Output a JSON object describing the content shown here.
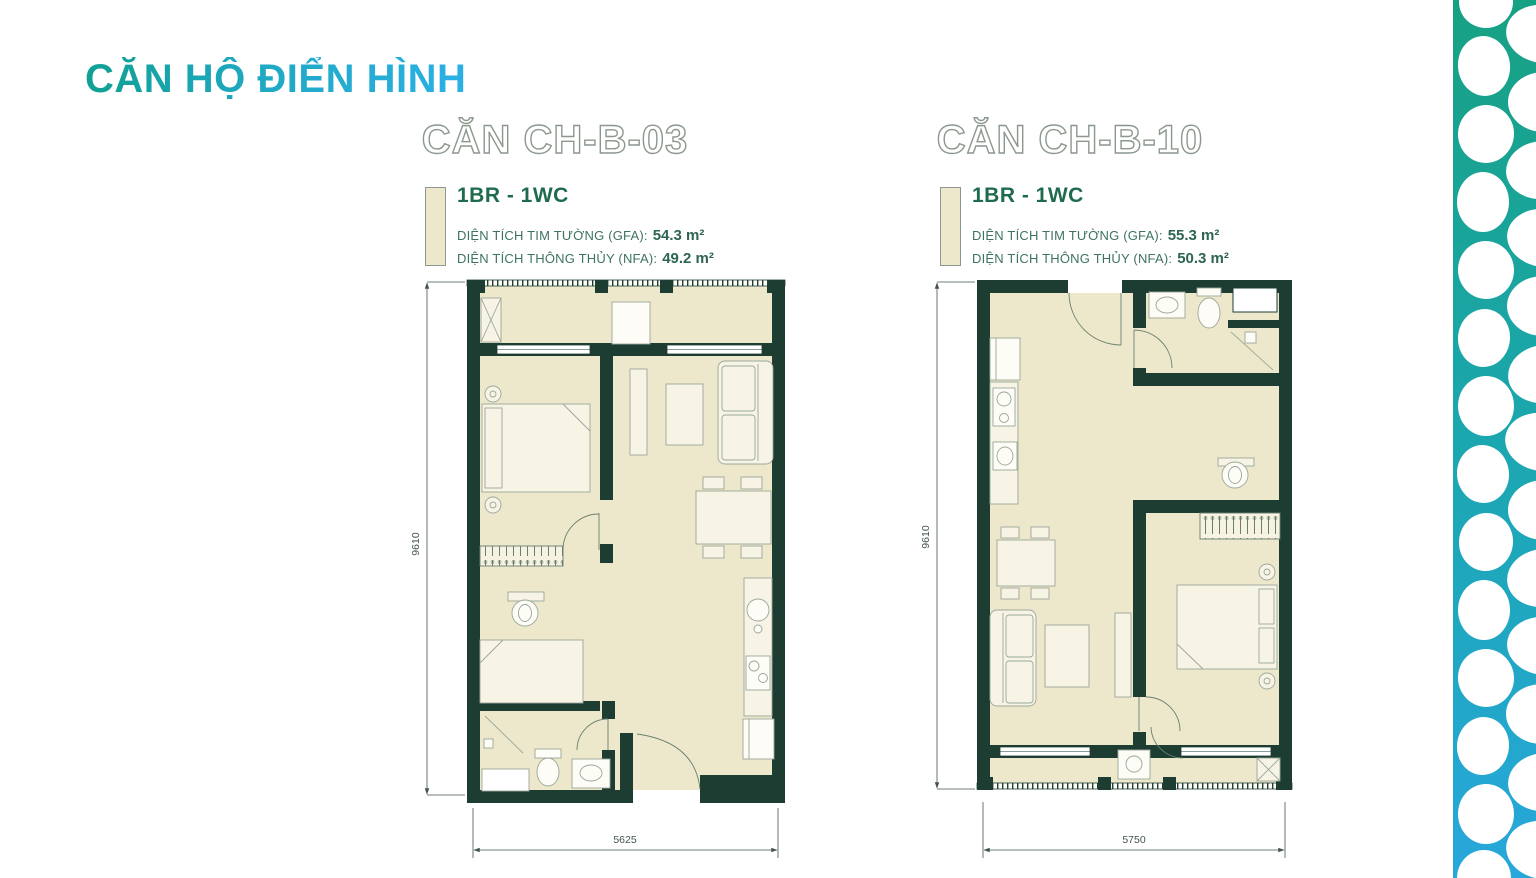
{
  "title": "CĂN HỘ ĐIỂN HÌNH",
  "units": [
    {
      "name": "CĂN CH-B-03",
      "type": "1BR - 1WC",
      "gfa_label": "DIỆN TÍCH TIM TƯỜNG (GFA):",
      "gfa_value": "54.3 m²",
      "nfa_label": "DIỆN TÍCH THÔNG THỦY (NFA):",
      "nfa_value": "49.2 m²",
      "width_dim": "5625",
      "height_dim": "9610"
    },
    {
      "name": "CĂN CH-B-10",
      "type": "1BR - 1WC",
      "gfa_label": "DIỆN TÍCH TIM TƯỜNG (GFA):",
      "gfa_value": "55.3 m²",
      "nfa_label": "DIỆN TÍCH THÔNG THỦY (NFA):",
      "nfa_value": "50.3 m²",
      "width_dim": "5750",
      "height_dim": "9610"
    }
  ],
  "colors": {
    "title_gradient_start": "#0FA093",
    "title_gradient_end": "#2BB0E5",
    "wall": "#1E3D32",
    "floor": "#EDE8CB",
    "type_green": "#1F6B4E",
    "area_text_green": "#3E7360",
    "header_outline": "#8C988E",
    "pattern_top": "#17A183",
    "pattern_bottom": "#27A7DB"
  }
}
